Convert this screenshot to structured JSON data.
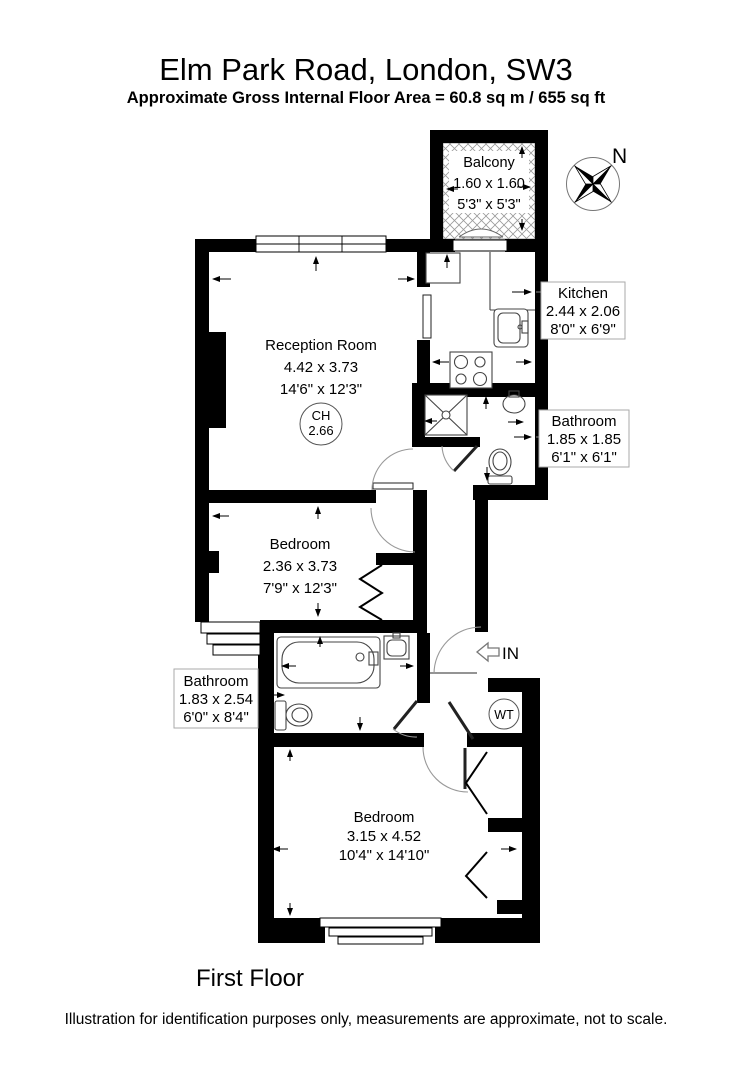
{
  "header": {
    "title": "Elm Park Road, London, SW3",
    "subtitle": "Approximate Gross Internal Floor Area = 60.8 sq m / 655 sq ft"
  },
  "footer": {
    "floor_label": "First Floor",
    "disclaimer": "Illustration for identification purposes only, measurements are approximate, not to scale."
  },
  "compass": {
    "north_label": "N"
  },
  "entrance": {
    "label": "IN"
  },
  "rooms": {
    "balcony": {
      "name": "Balcony",
      "metric": "1.60 x 1.60",
      "imperial": "5'3\" x 5'3\""
    },
    "reception": {
      "name": "Reception Room",
      "metric": "4.42 x 3.73",
      "imperial": "14'6\" x 12'3\"",
      "ch_label": "CH",
      "ch_value": "2.66"
    },
    "kitchen": {
      "name": "Kitchen",
      "metric": "2.44 x 2.06",
      "imperial": "8'0\" x 6'9\""
    },
    "bathroom_upper": {
      "name": "Bathroom",
      "metric": "1.85 x 1.85",
      "imperial": "6'1\" x 6'1\""
    },
    "bedroom_middle": {
      "name": "Bedroom",
      "metric": "2.36 x 3.73",
      "imperial": "7'9\" x 12'3\""
    },
    "bathroom_lower": {
      "name": "Bathroom",
      "metric": "1.83 x 2.54",
      "imperial": "6'0\" x 8'4\""
    },
    "bedroom_bottom": {
      "name": "Bedroom",
      "metric": "3.15 x 4.52",
      "imperial": "10'4\" x 14'10\""
    },
    "water_tank": {
      "label": "WT"
    }
  },
  "colors": {
    "walls": "#000000",
    "fixtures": "#444444",
    "label_box_border": "#aaaaaa"
  }
}
